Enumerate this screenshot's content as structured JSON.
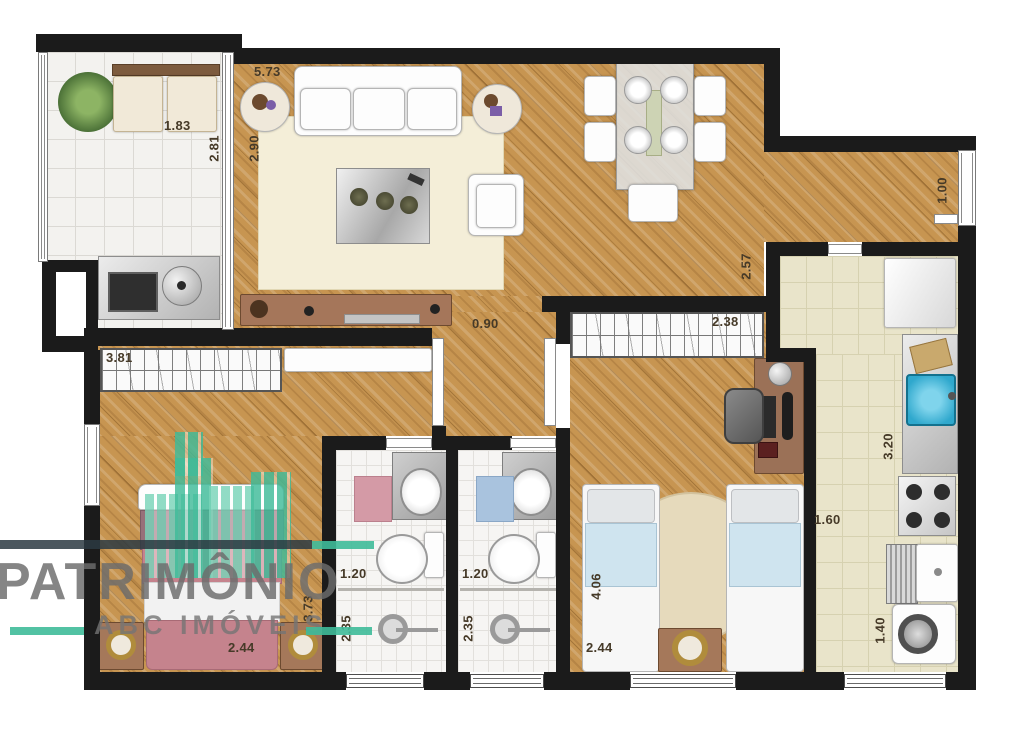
{
  "brand": {
    "name": "PATRIMÔNIO",
    "subtitle": "ABC IMÓVEIS"
  },
  "colors": {
    "wall": "#1b1b1b",
    "wood": "#c79551",
    "watermark_teal": "#3fbb99",
    "watermark_gray": "#6c6c6c",
    "sink_blue": "#2fa8cd",
    "rug_pink": "#d49aa6",
    "rug_blue": "#a9c3de",
    "bed_pink": "#c5838d",
    "bed_blue": "#cfe4ef"
  },
  "labels": {
    "balcony_width": "1.83",
    "balcony_depth": "2.81",
    "living_width": "5.73",
    "living_depth": "2.90",
    "hall_width": "0.90",
    "living_right": "2.57",
    "entry_door": "1.00",
    "kitchen_depth": "3.20",
    "kitchen_width": "1.60",
    "laundry_width": "1.40",
    "master_wardrobe": "3.81",
    "master_depth": "3.73",
    "master_width": "2.44",
    "bath1_width": "1.20",
    "bath1_depth": "2.35",
    "bath2_width": "1.20",
    "bath2_depth": "2.35",
    "bedroom2_wardrobe": "2.38",
    "bedroom2_depth": "4.06",
    "bedroom2_width": "2.44"
  }
}
